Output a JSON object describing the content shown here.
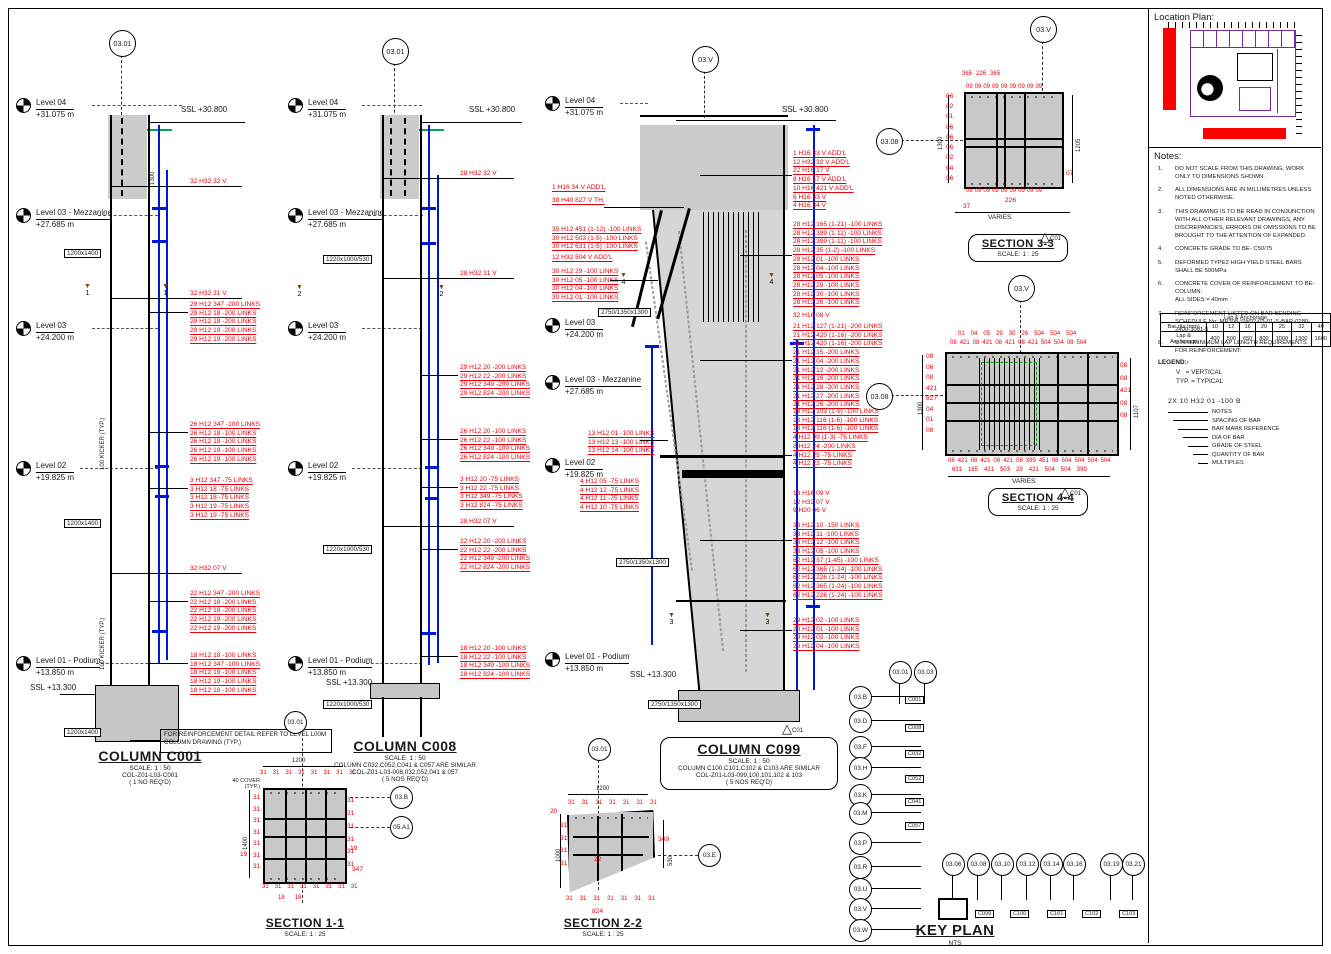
{
  "page": {
    "ssl_top": "SSL +30.800",
    "ssl_bottom": "SSL +13.300",
    "rev": "C01"
  },
  "levels": {
    "l04": {
      "name": "Level 04",
      "elev": "+31.075 m"
    },
    "l03m": {
      "name": "Level 03 - Mezzanine",
      "elev": "+27.685 m"
    },
    "l03": {
      "name": "Level 03",
      "elev": "+24.200 m"
    },
    "l02": {
      "name": "Level 02",
      "elev": "+19.825 m"
    },
    "l01": {
      "name": "Level 01 - Podium",
      "elev": "+13.850 m"
    }
  },
  "c001": {
    "grid_bubble": "03.01",
    "size_label": "1200x1400",
    "kicker": "100 KICKER (TYP.)",
    "dim_1300": "1300",
    "cut_no": "1",
    "v_top": "32 H32 32 V",
    "v_mid": "32 H32 31 V",
    "v_low": "32 H32 07 V",
    "links_a": [
      "29 H12 347 -200 LINKS",
      "29 H12 18 -200 LINKS",
      "29 H12 18 -200 LINKS",
      "29 H12 19 -200 LINKS",
      "29 H12 19 -200 LINKS"
    ],
    "links_b": [
      "26 H12 347 -100 LINKS",
      "26 H12 18 -100 LINKS",
      "26 H12 18 -100 LINKS",
      "26 H12 19 -100 LINKS",
      "26 H12 19 -100 LINKS"
    ],
    "links_c": [
      "3 H12 347 -75 LINKS",
      "3 H12 18 -75 LINKS",
      "3 H12 18 -75 LINKS",
      "3 H12 19 -75 LINKS",
      "3 H12 19 -75 LINKS"
    ],
    "links_d": [
      "22 H12 347 -200 LINKS",
      "22 H12 18 -200 LINKS",
      "22 H12 18 -200 LINKS",
      "22 H12 19 -200 LINKS",
      "22 H12 19 -200 LINKS"
    ],
    "links_e": [
      "18 H12 18 -100 LINKS",
      "18 H12 347 -100 LINKS",
      "18 H12 19 -100 LINKS",
      "18 H12 19 -100 LINKS",
      "18 H12 18 -100 LINKS"
    ],
    "note_box": "FOR REINFORCEMENT DETAIL REFER TO LEVEL L00M COLUMN DRAWING (TYP.)",
    "title": "COLUMN C001",
    "scale": "SCALE:  1 : 50",
    "ref": "COL-Z01-L03-C001",
    "req": "( 1 NO REQ'D)"
  },
  "c008": {
    "grid_bubble": "03.01",
    "size_label": "1220x1000/530",
    "cut_no": "2",
    "v_top": "28 H32 32 V",
    "v_mid": "28 H32 31 V",
    "v_low": "28 H32 07 V",
    "links_a": [
      "29 H12 20 -200 LINKS",
      "29 H12 22 -200 LINKS",
      "29 H12 349 -200 LINKS",
      "29 H12 824 -200 LINKS"
    ],
    "links_b": [
      "26 H12 20 -100 LINKS",
      "26 H12 22 -100 LINKS",
      "26 H12 349 -100 LINKS",
      "26 H12 824 -100 LINKS"
    ],
    "links_c": [
      "3 H12 20 -75 LINKS",
      "3 H12 22 -75 LINKS",
      "3 H12 349 -75 LINKS",
      "3 H12 824 -75 LINKS"
    ],
    "links_d": [
      "22 H12 20 -200 LINKS",
      "22 H12 22 -200 LINKS",
      "22 H12 349 -200 LINKS",
      "22 H12 824 -200 LINKS"
    ],
    "links_e": [
      "18 H12 20 -100 LINKS",
      "18 H12 22 -100 LINKS",
      "18 H12 349 -100 LINKS",
      "18 H12 824 -100 LINKS"
    ],
    "title": "COLUMN C008",
    "scale": "SCALE:  1 : 50",
    "similar": "COLUMN C032,C052,C041 & C057 ARE SIMILAR",
    "ref": "COL-Z01-L03-008,032,052,041 & 057",
    "req": "( 5 NOS REQ'D)"
  },
  "c099": {
    "grid_bubble": "03.V",
    "size_label": "2750/1350x1300",
    "cut_no_3": "3",
    "cut_no_4": "4",
    "left_1": [
      "1 H16 34 V ADD'L"
    ],
    "left_2": [
      "38 H40 827 V TH."
    ],
    "left_3": [
      "30 H12 451 (1-12) -100 LINKS",
      "30 H12 503 (1-5) -100 LINKS",
      "30 H12 631 (1-5) -100 LINKS"
    ],
    "left_4": [
      "12 H32 504 V ADD'L"
    ],
    "left_5": [
      "30 H12 29 -100 LINKS",
      "30 H12 05 -100 LINKS",
      "30 H12 04 -100 LINKS",
      "30 H12 01 -100 LINKS"
    ],
    "left_6": [
      "13 H12 01 -100 LINKS",
      "13 H12 13 -100 LINKS",
      "13 H12 14 -100 LINKS"
    ],
    "left_7": [
      "4 H12 05 -75 LINKS",
      "4 H12 12 -75 LINKS",
      "4 H12 11 -75 LINKS",
      "4 H12 10 -75 LINKS"
    ],
    "right_1": [
      "1 H16 33 V ADD'L",
      "12 H32 32 V ADD'L",
      "22 H16 17 V",
      "8 H16 17 V ADD'L",
      "10 H16 421 V ADD'L",
      "6 H16 33 V",
      "4 H16 34 V"
    ],
    "right_2": [
      "28 H12 165 (1-21) -100 LINKS",
      "28 H12 399 (1-11) -100 LINKS",
      "28 H12 399 (1-11) -100 LINKS",
      "28 H12 35 (1-2) -100 LINKS",
      "28 H12 01 -100 LINKS",
      "28 H12 04 -100 LINKS",
      "28 H12 05 -100 LINKS",
      "28 H12 29 -100 LINKS",
      "28 H12 30 -100 LINKS",
      "28 H12 26 -100 LINKS"
    ],
    "right_3": [
      "32 H16 08 V"
    ],
    "right_4": [
      "21 H12 127 (1-21) -200 LINKS",
      "21 H12 420 (1-16) -200 LINKS",
      "21 H12 420 (1-16) -200 LINKS",
      "21 H12 15 -200 LINKS",
      "21 H12 04 -200 LINKS",
      "21 H12 12 -200 LINKS",
      "21 H12 16 -200 LINKS",
      "21 H12 28 -200 LINKS",
      "21 H12 27 -200 LINKS",
      "21 H12 26 -200 LINKS"
    ],
    "right_5": [
      "13 H12 103 (1-9) -100 LINKS",
      "13 H12 116 (1-6) -100 LINKS",
      "13 H12 116 (1-6) -100 LINKS",
      "4 H12 99 (1-3) -75 LINKS"
    ],
    "right_6": [
      "8 H12 24 -200 LINKS",
      "4 H12 25 -75 LINKS",
      "4 H12 23 -75 LINKS"
    ],
    "right_7": [
      "18 H16 09 V",
      "12 H32 07 V",
      "9 H20 06 V"
    ],
    "right_8": [
      "33 H12 10 -150 LINKS",
      "33 H12 11 -100 LINKS",
      "33 H12 12 -100 LINKS",
      "33 H12 05 -100 LINKS"
    ],
    "right_9": [
      "62 H12 37 (1-45) -100 LINKS",
      "62 H12 365 (1-24) -100 LINKS",
      "62 H12 226 (1-24) -100 LINKS",
      "62 H12 365 (1-24) -100 LINKS",
      "62 H12 226 (1-24) -100 LINKS"
    ],
    "right_10": [
      "29 H12 02 -100 LINKS",
      "29 H12 01 -100 LINKS",
      "29 H12 03 -100 LINKS",
      "29 H12 04 -100 LINKS"
    ],
    "title": "COLUMN C099",
    "scale": "SCALE:  1 : 50",
    "similar": "COLUMN C100,C101,C102 & C103 ARE SIMILAR",
    "ref": "COL-Z01-L03-099,100,101,102 & 103",
    "req": "( 5 NOS REQ'D)"
  },
  "s11": {
    "title": "SECTION 1-1",
    "scale": "SCALE:  1 : 25",
    "dim_top": "1200",
    "dim_left": "1400",
    "cover": "40 COVER\n(TYP.)",
    "grid_bubble": "03.01",
    "bubble_a": "03.B",
    "bubble_b": "05.A1",
    "marks_top": [
      "31",
      "31",
      "31",
      "31",
      "31",
      "31",
      "31",
      "31"
    ],
    "marks_bottom": [
      "31",
      "31",
      "31",
      "31",
      "31",
      "31",
      "31",
      "31"
    ],
    "marks_left": [
      "31",
      "31",
      "31",
      "31",
      "31",
      "31",
      "31"
    ],
    "marks_right": [
      "31",
      "31",
      "31",
      "31",
      "31",
      "31"
    ],
    "mark_19l": "19",
    "mark_19r": "19",
    "mark_347": "347",
    "marks_18": [
      "18",
      "18"
    ]
  },
  "s22": {
    "title": "SECTION 2-2",
    "scale": "SCALE:  1 : 25",
    "dim_top": "1200",
    "dim_left": "1000",
    "dim_right": "530",
    "grid_bubble": "03.01",
    "bubble": "03.E",
    "marks_top": [
      "31",
      "31",
      "31",
      "31",
      "31",
      "31",
      "31"
    ],
    "marks_bottom": [
      "31",
      "31",
      "31",
      "31",
      "31",
      "31",
      "31"
    ],
    "marks_left": [
      "31",
      "31",
      "31",
      "31"
    ],
    "mark_20": "20",
    "mark_22": "22",
    "mark_349": "349",
    "mark_824": "824"
  },
  "s33": {
    "title": "SECTION 3-3",
    "scale": "SCALE:  1 : 25",
    "bubble_top": "03.V",
    "bubble_left": "03.08",
    "dim_left": "1300",
    "dim_right": "1205",
    "dim_bottom": "VARIES",
    "top_bars": [
      "365",
      "226",
      "365"
    ],
    "ticks_top": [
      "09",
      "09",
      "09",
      "09",
      "09",
      "09",
      "09",
      "09",
      "09"
    ],
    "ticks_bottom": [
      "09",
      "09",
      "09",
      "09",
      "09",
      "09",
      "09",
      "09",
      "09"
    ],
    "marks_left": [
      "06",
      "02",
      "01",
      "06",
      "06",
      "06",
      "02",
      "04",
      "06"
    ],
    "mark_right": "07",
    "mark_226": "226",
    "mark_37": "37"
  },
  "s44": {
    "title": "SECTION 4-4",
    "scale": "SCALE:  1 : 25",
    "bubble_top": "03.V",
    "bubble_left": "03.08",
    "dim_left": "1300",
    "dim_right": "1107",
    "dim_bottom": "VARIES",
    "top_row1": [
      "01",
      "04",
      "05",
      "29",
      "30",
      "26",
      "504",
      "504",
      "504"
    ],
    "top_row2": [
      "08",
      "421",
      "08",
      "421",
      "08",
      "421",
      "08",
      "421",
      "504",
      "504",
      "08",
      "504"
    ],
    "bottom_row1": [
      "08",
      "421",
      "08",
      "421",
      "08",
      "421",
      "08",
      "399",
      "451",
      "08",
      "504",
      "504",
      "504",
      "504"
    ],
    "bottom_row2": [
      "631",
      "165",
      "421",
      "503",
      "29",
      "421",
      "504",
      "504",
      "399"
    ],
    "marks_left": [
      "08",
      "06",
      "08",
      "421",
      "827",
      "04",
      "01",
      "08"
    ],
    "marks_right": [
      "08",
      "08",
      "421",
      "08",
      "08"
    ]
  },
  "keyplan": {
    "title": "KEY PLAN",
    "scale": "NTS",
    "left_bubbles": [
      "03.B",
      "03.D",
      "03.F",
      "03.H",
      "03.K",
      "03.M",
      "03.P",
      "03.R",
      "03.U",
      "03.V",
      "03.W"
    ],
    "top_bubbles": [
      "03.01",
      "03.03"
    ],
    "bottom_bubbles": [
      "03.06",
      "03.08",
      "03.10",
      "03.12",
      "03.14",
      "03.16",
      "03.19",
      "03.21"
    ],
    "left_tags": [
      "C001",
      "C008",
      "C032",
      "C052",
      "C041",
      "C057"
    ],
    "bottom_tags": [
      "C099",
      "C100",
      "C101",
      "C102",
      "C103"
    ]
  },
  "location_plan": {
    "title": "Location Plan:"
  },
  "notes": {
    "title": "Notes:",
    "items": [
      {
        "no": "1.",
        "tx": "DO NOT SCALE FROM THIS DRAWING, WORK ONLY TO DIMENSIONS SHOWN."
      },
      {
        "no": "2.",
        "tx": "ALL DIMENSIONS ARE IN MILLIMETRES UNLESS NOTED OTHERWISE."
      },
      {
        "no": "3.",
        "tx": "THIS DRAWING IS TO BE READ IN CONJUNCTION WITH ALL OTHER RELEVANT DRAWINGS, ANY DISCREPANCIES, ERRORS OR OMISSIONS TO BE BROUGHT TO THE ATTENTION OF EXPANDED."
      },
      {
        "no": "4.",
        "tx": "CONCRETE GRADE TO BE-   C50/75"
      },
      {
        "no": "5.",
        "tx": "DEFORMED TYPE2 HIGH YIELD STEEL BARS SHALL BE 500MPa"
      },
      {
        "no": "6.",
        "tx": "CONCRETE COVER OF REINFORCEMENT TO BE-\nCOLUMN:\n    ALL SIDES = 40mm"
      },
      {
        "no": "7.",
        "tx": "REINFORCEMENT LISTED ON BAR BENDING SCHEDULE No: MP308-SW02-03-01-S-BAR-0280-2400-3001-5"
      },
      {
        "no": "8.",
        "tx": "U.N.O MINIMUM LAP LENGTH REQUIREMENTS FOR REINFORCEMENT:"
      }
    ]
  },
  "lap_table": {
    "header": "Lap & Anchorage",
    "row1_label": "Bar dia (mm)",
    "row1": [
      "10",
      "12",
      "16",
      "20",
      "25",
      "32",
      "40"
    ],
    "row2_label": "Lap & Anchorage",
    "row2": [
      "400",
      "500",
      "650",
      "800",
      "1000",
      "1300",
      "1600"
    ]
  },
  "legend": {
    "title": "LEGEND:-",
    "v_abbr": "V",
    "v_def": "=  VERTICAL",
    "typ_abbr": "TYP.",
    "typ_def": "=  TYPICAL",
    "callout_example": "2X 10 H32 01 -100 B",
    "callout_labels": [
      "NOTES",
      "SPACING OF BAR",
      "BAR MARK REFERENCE",
      "DIA OF BAR",
      "GRADE OF STEEL",
      "QUANTITY OF BAR",
      "MULTIPLES"
    ]
  },
  "colors": {
    "rebar_red": "#e8000d",
    "lap_blue": "#0017d8",
    "plan_purple": "#7030a0",
    "highlight_red": "#ff0000"
  }
}
